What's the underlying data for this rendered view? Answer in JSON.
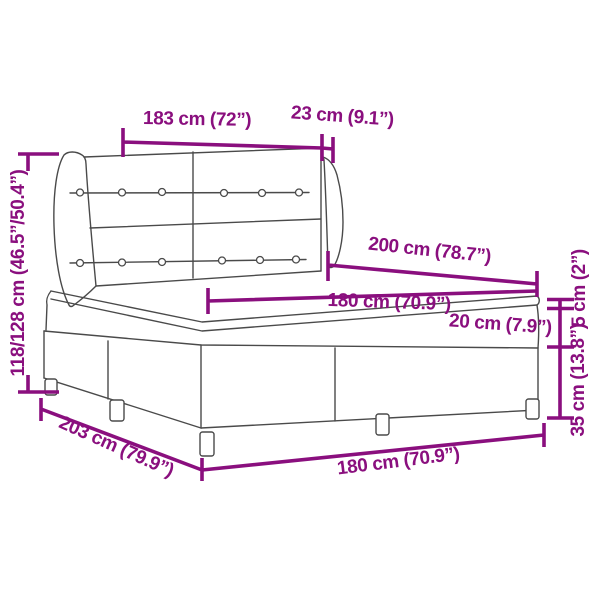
{
  "diagram": {
    "subject": "box-spring-bed-with-winged-tufted-headboard",
    "style": "technical dimension line drawing"
  },
  "colors": {
    "dimension_color": "#8a0f7e",
    "outline_color": "#4a4a4a",
    "background": "#ffffff"
  },
  "labels": {
    "headboard_width": "183 cm (72”)",
    "headboard_wing_depth": "23 cm (9.1”)",
    "overall_height": "118/128 cm (46.5”/50.4”)",
    "mattress_length": "200 cm (78.7”)",
    "mattress_width": "180 cm (70.9”)",
    "mattress_thickness": "20 cm (7.9”)",
    "pillow_top_thickness": "5 cm (2”)",
    "base_height_with_legs": "35 cm (13.8”)",
    "base_length": "203 cm (79.9”)",
    "base_width": "180 cm (70.9”)"
  }
}
